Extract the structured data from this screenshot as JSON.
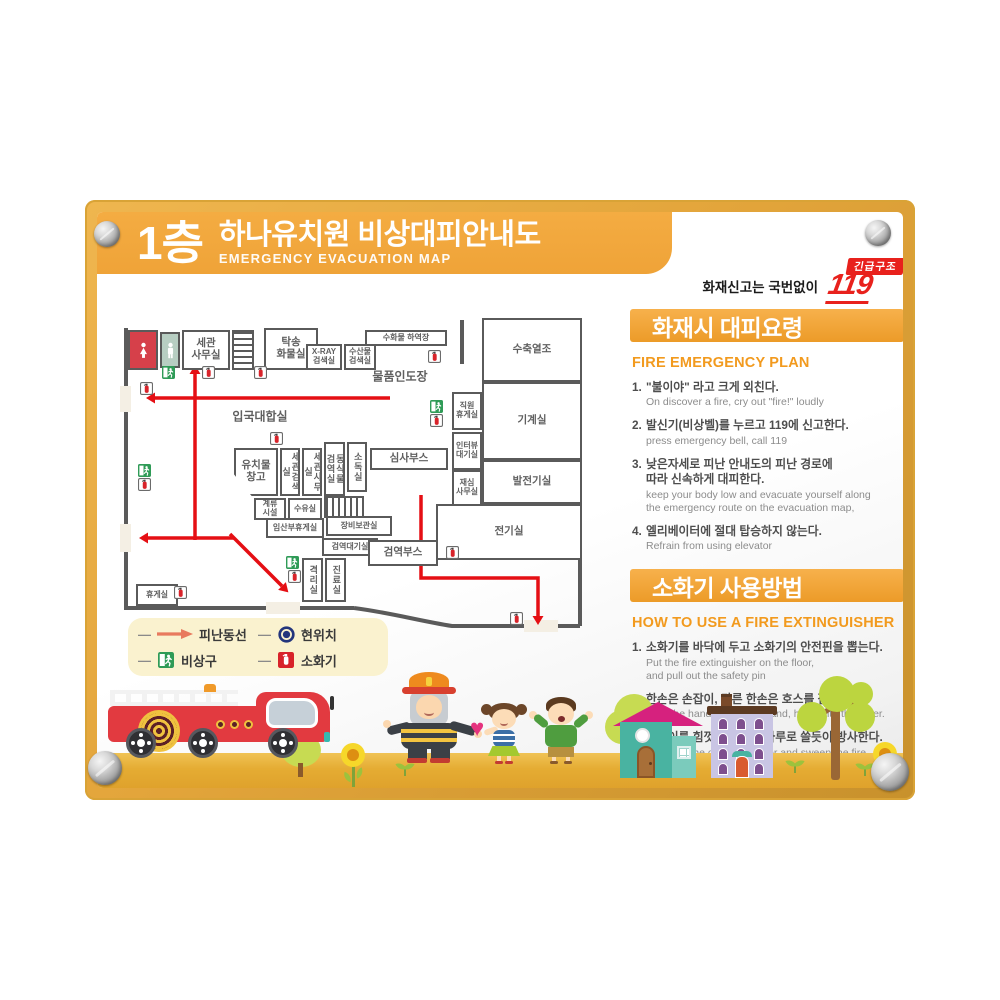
{
  "board": {
    "floor": "1층",
    "title": "하나유치원 비상대피안내도",
    "subtitle": "EMERGENCY EVACUATION MAP"
  },
  "call": {
    "label": "화재신고는 국번없이",
    "badge": "긴급구조",
    "number": "119"
  },
  "sections": {
    "fire_plan": {
      "heading": "화재시 대피요령",
      "subheading": "FIRE EMERGENCY PLAN",
      "items": [
        {
          "no": "1.",
          "ko": "\"불이야\" 라고 크게 외친다.",
          "en": "On discover a fire, cry out \"fire!\" loudly"
        },
        {
          "no": "2.",
          "ko": "발신기(비상벨)를 누르고 119에 신고한다.",
          "en": "press emergency bell, call 119"
        },
        {
          "no": "3.",
          "ko": "낮은자세로 피난 안내도의 피난 경로에\n따라 신속하게 대피한다.",
          "en": "keep your body low and evacuate yourself along\nthe emergency route on the evacuation map,"
        },
        {
          "no": "4.",
          "ko": "엘리베이터에 절대 탑승하지 않는다.",
          "en": "Refrain from using elevator"
        }
      ]
    },
    "extinguisher": {
      "heading": "소화기 사용방법",
      "subheading": "HOW TO USE A FIRE EXTINGUISHER",
      "items": [
        {
          "no": "1.",
          "ko": "소화기를 바닥에 두고 소화기의 안전핀을 뽑는다.",
          "en": "Put the fire extinguisher on the floor,\nand pull out the safety pin"
        },
        {
          "no": "2.",
          "ko": "한손은 손잡이, 다른 한손은 호스를 잡는다.",
          "en": "Hold the handle with one hand, hose with the other."
        },
        {
          "no": "3.",
          "ko": "손잡이를 힘껏 누르고 빗자루로 쓸듯이 방사한다.",
          "en": "Squeeze the operation lever and sweep the fire"
        }
      ]
    }
  },
  "legend": {
    "items": [
      {
        "type": "route",
        "label": "피난동선"
      },
      {
        "type": "location",
        "label": "현위치"
      },
      {
        "type": "exit",
        "label": "비상구"
      },
      {
        "type": "ext",
        "label": "소화기"
      }
    ]
  },
  "plan": {
    "colors": {
      "wall": "#5A5A5A",
      "route": "#E50F14",
      "door": "#F4EFE4"
    },
    "rooms": [
      {
        "id": "toilet-women",
        "x": 10,
        "y": 18,
        "w": 30,
        "h": 40,
        "fill": "#D6404A",
        "icon": "female"
      },
      {
        "id": "toilet-men",
        "x": 42,
        "y": 20,
        "w": 20,
        "h": 36,
        "fill": "#B7CEC2",
        "icon": "male"
      },
      {
        "id": "customs-office-top",
        "label": "세관\n사무실",
        "x": 64,
        "y": 18,
        "w": 48,
        "h": 40
      },
      {
        "id": "stairs-top",
        "x": 114,
        "y": 18,
        "w": 22,
        "h": 40,
        "hatch": "h"
      },
      {
        "id": "cargo-room",
        "label": "탁송\n화물실",
        "x": 146,
        "y": 16,
        "w": 54,
        "h": 42
      },
      {
        "id": "xray-room",
        "label": "X-RAY\n검색실",
        "x": 188,
        "y": 32,
        "w": 36,
        "h": 26,
        "small": true
      },
      {
        "id": "seafood-room",
        "label": "수산물\n검색실",
        "x": 226,
        "y": 32,
        "w": 32,
        "h": 26,
        "small": true
      },
      {
        "id": "baggage-unload",
        "label": "수화물 하역장",
        "x": 247,
        "y": 18,
        "w": 82,
        "h": 16,
        "small": true
      },
      {
        "id": "heat-tank",
        "label": "수축열조",
        "x": 364,
        "y": 6,
        "w": 100,
        "h": 64
      },
      {
        "id": "machine-room",
        "label": "기계실",
        "x": 364,
        "y": 70,
        "w": 100,
        "h": 78
      },
      {
        "id": "staff-lounge",
        "label": "직원\n휴게실",
        "x": 334,
        "y": 80,
        "w": 30,
        "h": 38,
        "small": true
      },
      {
        "id": "interview-wait",
        "label": "인터뷰\n대기실",
        "x": 334,
        "y": 120,
        "w": 30,
        "h": 38,
        "small": true
      },
      {
        "id": "review-office",
        "label": "재심\n사무실",
        "x": 334,
        "y": 158,
        "w": 30,
        "h": 36,
        "small": true
      },
      {
        "id": "generator-room",
        "label": "발전기실",
        "x": 364,
        "y": 148,
        "w": 100,
        "h": 44
      },
      {
        "id": "electric-room",
        "label": "전기실",
        "x": 318,
        "y": 192,
        "w": 146,
        "h": 56
      },
      {
        "id": "inspection-booth",
        "label": "심사부스",
        "x": 252,
        "y": 136,
        "w": 78,
        "h": 22
      },
      {
        "id": "storage",
        "label": "유치물\n창고",
        "x": 116,
        "y": 136,
        "w": 44,
        "h": 48,
        "clip": "polygon(0 0,100% 0,100% 100%,40% 100%,0 55%)"
      },
      {
        "id": "customs-search",
        "label": "세관검색실",
        "x": 162,
        "y": 136,
        "w": 20,
        "h": 48,
        "vertical": true
      },
      {
        "id": "customs-office-mid",
        "label": "세관사무실",
        "x": 184,
        "y": 136,
        "w": 20,
        "h": 48,
        "vertical": true
      },
      {
        "id": "quarantine-animal",
        "label": "동식물\n검역실",
        "x": 206,
        "y": 130,
        "w": 21,
        "h": 54,
        "vertical": true
      },
      {
        "id": "disinfect-room",
        "label": "소독실",
        "x": 229,
        "y": 130,
        "w": 20,
        "h": 50,
        "vertical": true
      },
      {
        "id": "mooring",
        "label": "계류\n시설",
        "x": 136,
        "y": 186,
        "w": 32,
        "h": 22,
        "small": true
      },
      {
        "id": "nursing-room",
        "label": "수유실",
        "x": 170,
        "y": 186,
        "w": 34,
        "h": 22,
        "small": true
      },
      {
        "id": "stairs-mid",
        "x": 206,
        "y": 184,
        "w": 40,
        "h": 22,
        "hatch": "v"
      },
      {
        "id": "pregnant-lounge",
        "label": "임산부휴게실",
        "x": 148,
        "y": 206,
        "w": 58,
        "h": 20,
        "small": true
      },
      {
        "id": "equipment-room",
        "label": "장비보관실",
        "x": 208,
        "y": 204,
        "w": 66,
        "h": 20,
        "small": true
      },
      {
        "id": "quarantine-wait",
        "label": "검역대기실",
        "x": 204,
        "y": 226,
        "w": 56,
        "h": 18,
        "small": true
      },
      {
        "id": "quarantine-booth",
        "label": "검역부스",
        "x": 250,
        "y": 228,
        "w": 70,
        "h": 26
      },
      {
        "id": "isolation-room",
        "label": "격리실",
        "x": 184,
        "y": 246,
        "w": 21,
        "h": 44,
        "vertical": true
      },
      {
        "id": "treatment-room",
        "label": "진료실",
        "x": 207,
        "y": 246,
        "w": 21,
        "h": 44,
        "vertical": true
      },
      {
        "id": "rest-room",
        "label": "휴게실",
        "x": 18,
        "y": 272,
        "w": 42,
        "h": 22,
        "small": true
      }
    ],
    "area_labels": [
      {
        "label": "입국대합실",
        "x": 142,
        "y": 104
      },
      {
        "label": "물품인도장",
        "x": 282,
        "y": 64
      }
    ],
    "icons": [
      [
        "exit",
        44,
        54
      ],
      [
        "ext",
        84,
        54
      ],
      [
        "ext",
        136,
        54
      ],
      [
        "ext",
        22,
        70
      ],
      [
        "ext",
        310,
        38
      ],
      [
        "exit",
        312,
        88
      ],
      [
        "ext",
        312,
        102
      ],
      [
        "ext",
        152,
        120
      ],
      [
        "exit",
        20,
        152
      ],
      [
        "ext",
        20,
        166
      ],
      [
        "exit",
        168,
        244
      ],
      [
        "ext",
        170,
        258
      ],
      [
        "ext",
        328,
        234
      ],
      [
        "ext",
        392,
        300
      ],
      [
        "ext",
        56,
        274
      ]
    ],
    "doors": [
      [
        2,
        74,
        11,
        26
      ],
      [
        2,
        212,
        11,
        28
      ],
      [
        148,
        290,
        34,
        12
      ],
      [
        406,
        308,
        34,
        12
      ]
    ],
    "routes": [
      {
        "points": [
          [
            272,
            86
          ],
          [
            37,
            86
          ]
        ]
      },
      {
        "points": [
          [
            77,
            228
          ],
          [
            77,
            62
          ]
        ]
      },
      {
        "points": [
          [
            116,
            226
          ],
          [
            30,
            226
          ]
        ]
      },
      {
        "points": [
          [
            112,
            222
          ],
          [
            164,
            274
          ]
        ]
      },
      {
        "points": [
          [
            303,
            183
          ],
          [
            303,
            266
          ],
          [
            420,
            266
          ],
          [
            420,
            304
          ]
        ]
      }
    ]
  }
}
